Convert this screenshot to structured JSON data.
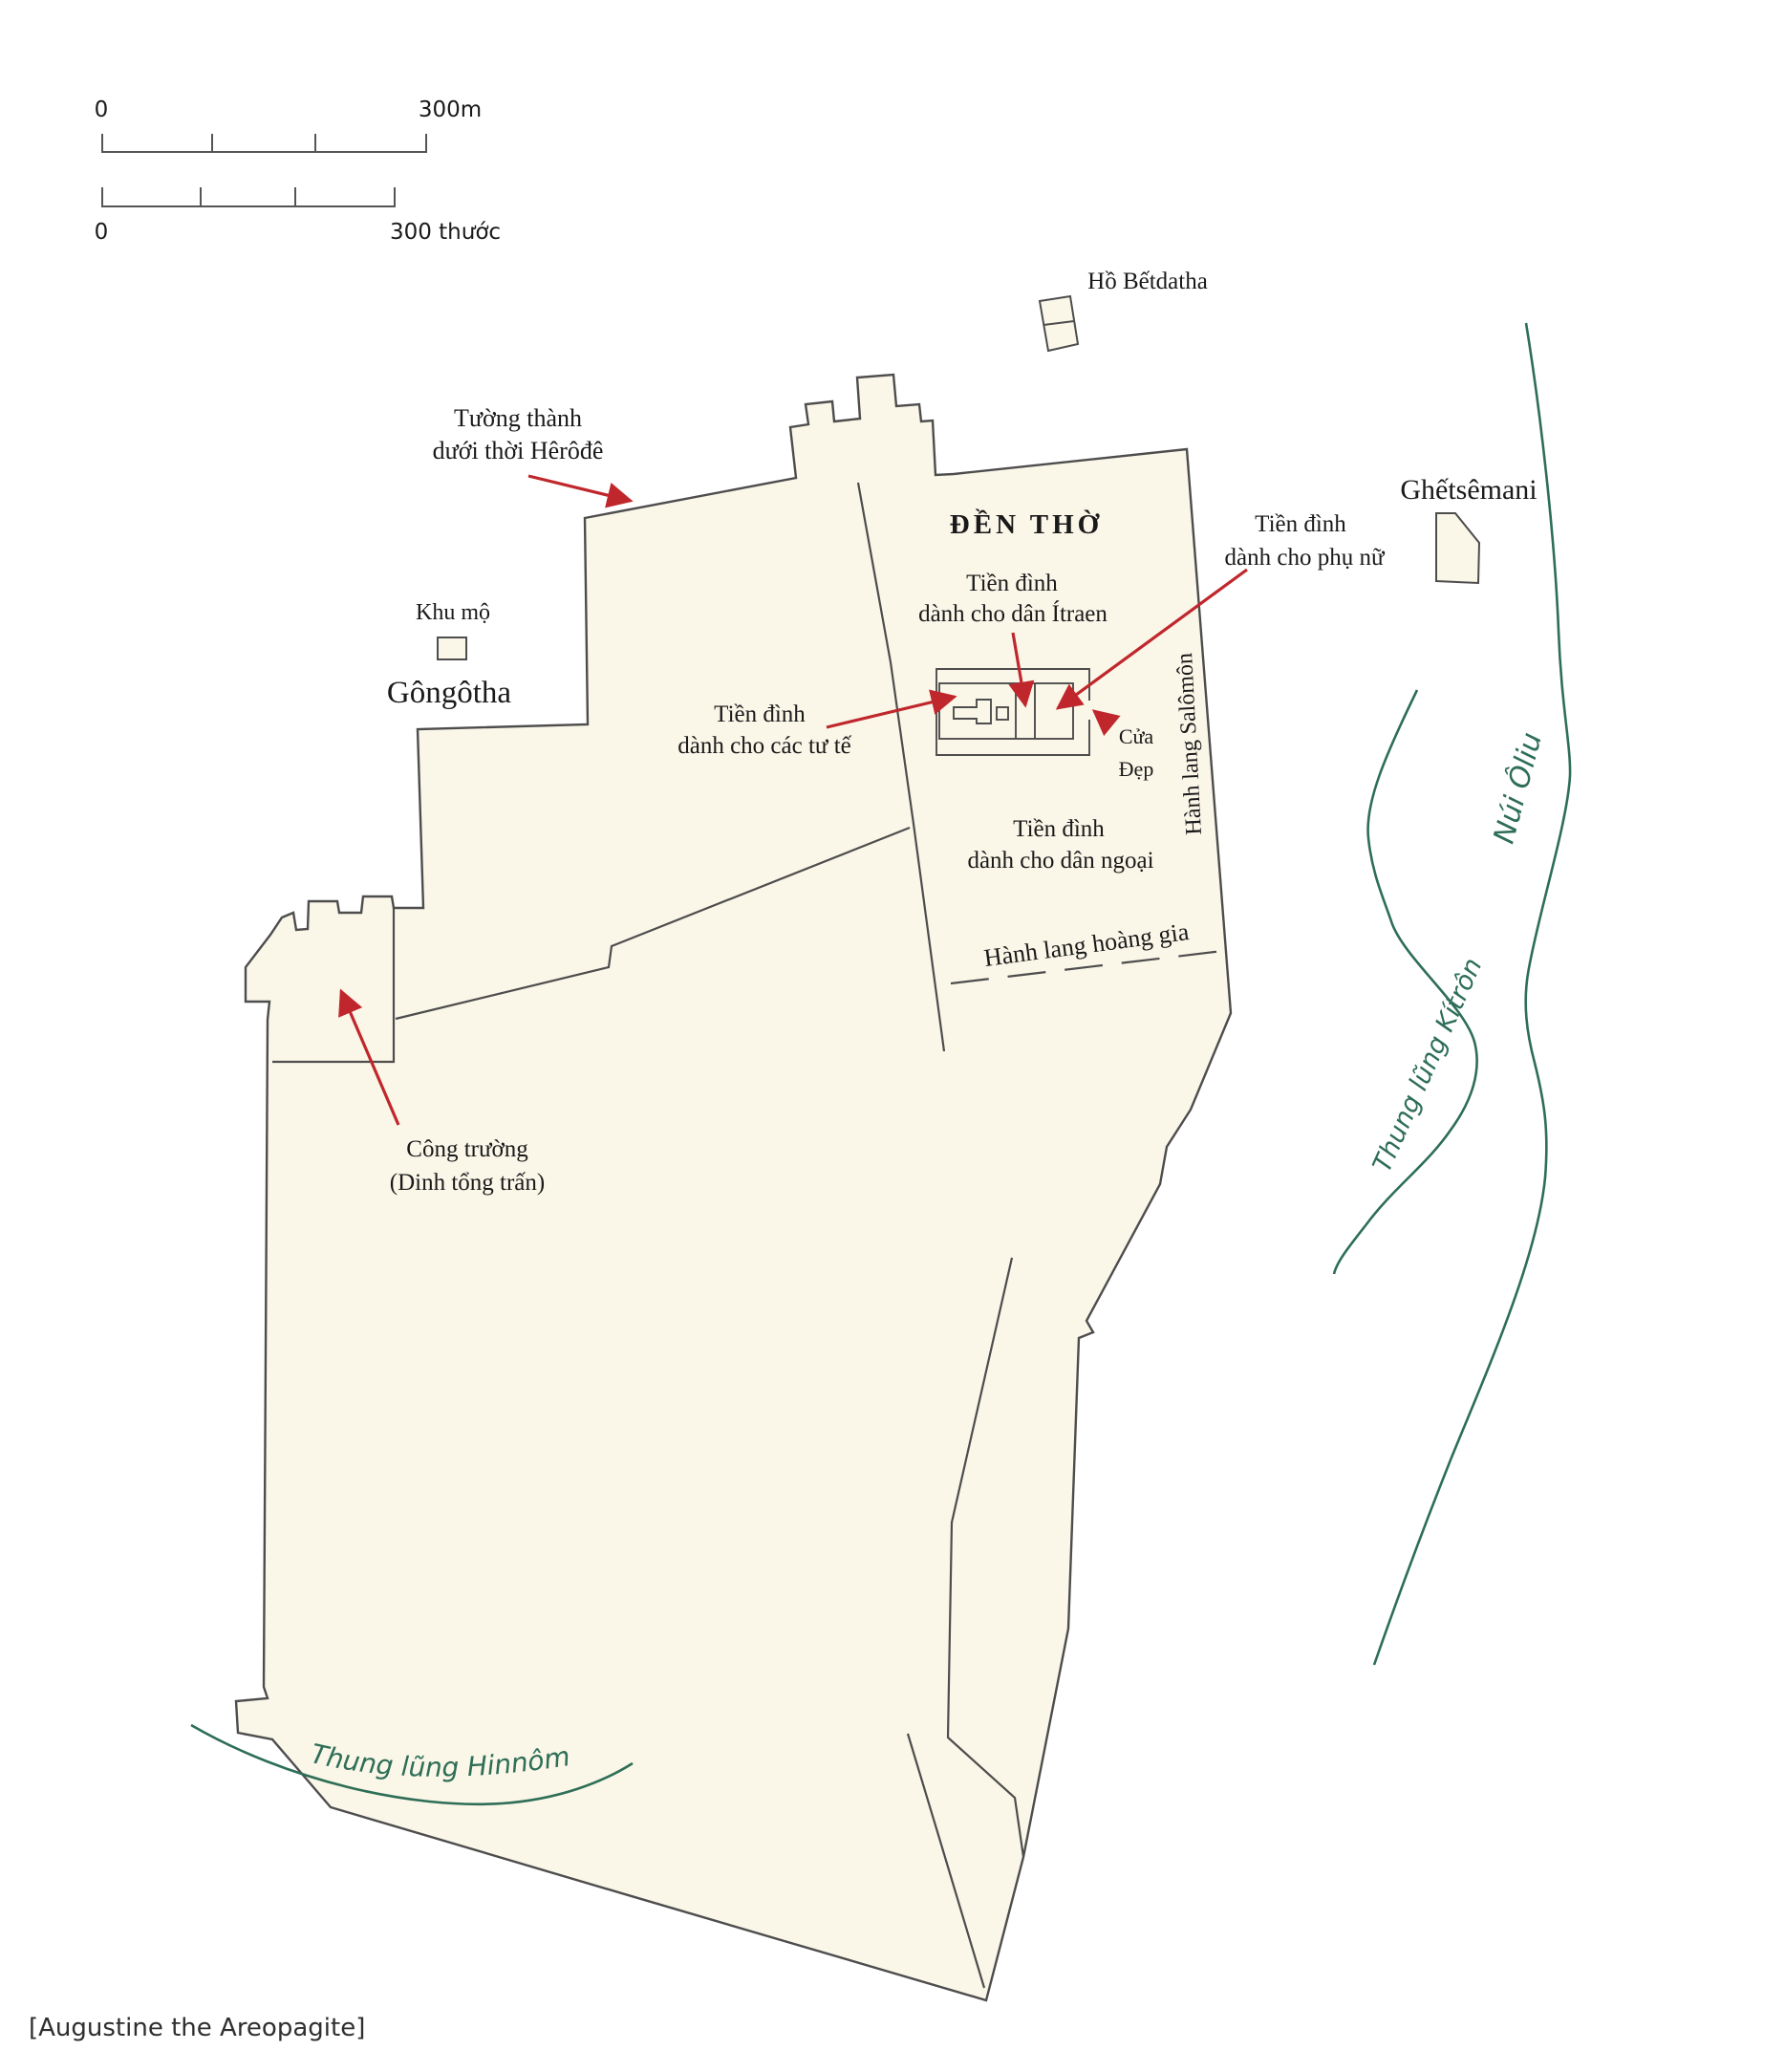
{
  "scale_bar": {
    "metric_zero": "0",
    "metric_max": "300m",
    "local_zero": "0",
    "local_max": "300 thước"
  },
  "labels": {
    "bethesda_pool": "Hồ Bếtdatha",
    "herod_wall_line1": "Tường thành",
    "herod_wall_line2": "dưới thời Hêrôđê",
    "tombs": "Khu mộ",
    "golgotha": "Gôngôtha",
    "temple": "ĐỀN THỜ",
    "israel_court_line1": "Tiền đình",
    "israel_court_line2": "dành cho dân Ítraen",
    "priests_court_line1": "Tiền đình",
    "priests_court_line2": "dành cho các tư tế",
    "women_court_line1": "Tiền đình",
    "women_court_line2": "dành cho phụ nữ",
    "beautiful_gate_line1": "Cửa",
    "beautiful_gate_line2": "Đẹp",
    "gethsemane": "Ghếtsêmani",
    "solomon_portico": "Hành lang Salômôn",
    "gentiles_court_line1": "Tiền đình",
    "gentiles_court_line2": "dành cho dân ngoại",
    "royal_portico": "Hành lang hoàng gia",
    "forum_line1": "Công trường",
    "forum_line2": "(Dinh tổng trấn)",
    "kidron_valley": "Thung lũng Kítrôn",
    "mount_of_olives": "Núi Ôliu",
    "hinnom_valley": "Thung lũng Hinnôm"
  },
  "caption": "[Augustine the Areopagite]",
  "colors": {
    "land_fill": "#faf6e8",
    "outline": "#4d4d4d",
    "arrow_red": "#c0272d",
    "valley_green": "#2e6e57",
    "text": "#1a1a1a"
  }
}
